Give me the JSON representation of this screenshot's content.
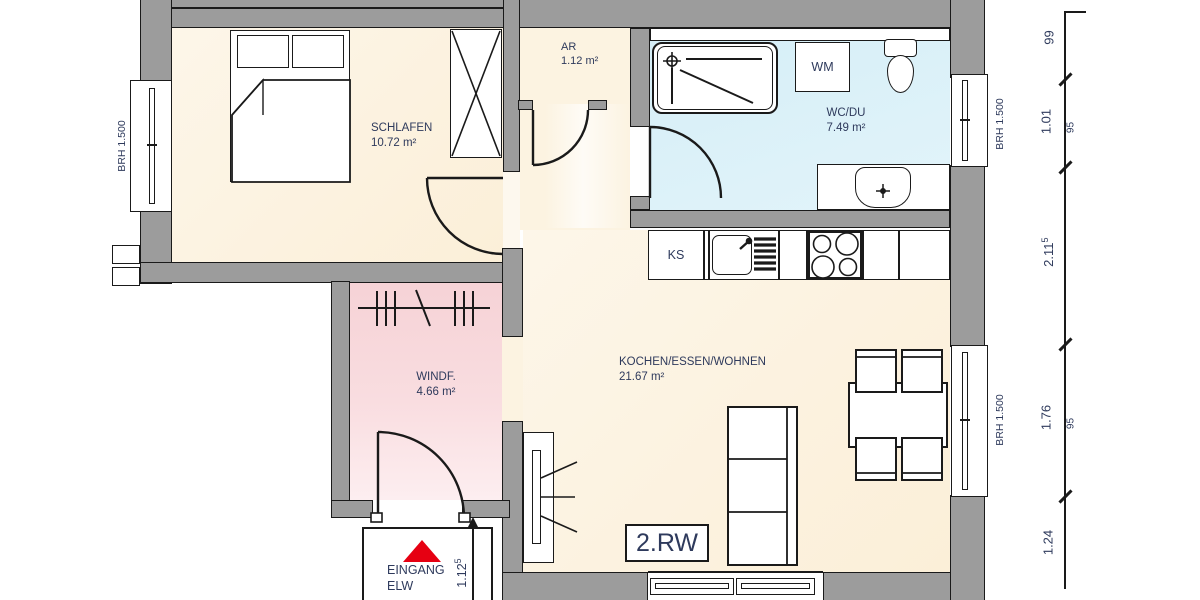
{
  "rooms": {
    "schlafen": {
      "name": "SCHLAFEN",
      "area": "10.72 m²"
    },
    "ar": {
      "name": "AR",
      "area": "1.12 m²"
    },
    "wcdu": {
      "name": "WC/DU",
      "area": "7.49 m²"
    },
    "wohnen": {
      "name": "KOCHEN/ESSEN/WOHNEN",
      "area": "21.67 m²"
    },
    "windf": {
      "name": "WINDF.",
      "area": "4.66 m²"
    }
  },
  "fixtures": {
    "ks": "KS",
    "wm": "WM"
  },
  "annotations": {
    "unit_label": "2.RW",
    "entrance_line1": "EINGANG",
    "entrance_line2": "ELW",
    "window_sill": "BRH 1.500"
  },
  "dimensions": {
    "v1": "99",
    "v2": "1.01",
    "v2_sub": "95",
    "v3_main": "2.11",
    "v3_sup": "5",
    "v4": "1.76",
    "v4_sub": "95",
    "v5": "1.24",
    "door_main": "1.12",
    "door_sup": "5"
  },
  "colors": {
    "wall": "#9c9c9c",
    "floor_warm": "#fcf2de",
    "floor_wet": "#d9f0f8",
    "floor_entry": "#f8d7db",
    "accent_red": "#e60012",
    "ink": "#2e3a5c",
    "line": "#1a1a1a"
  }
}
